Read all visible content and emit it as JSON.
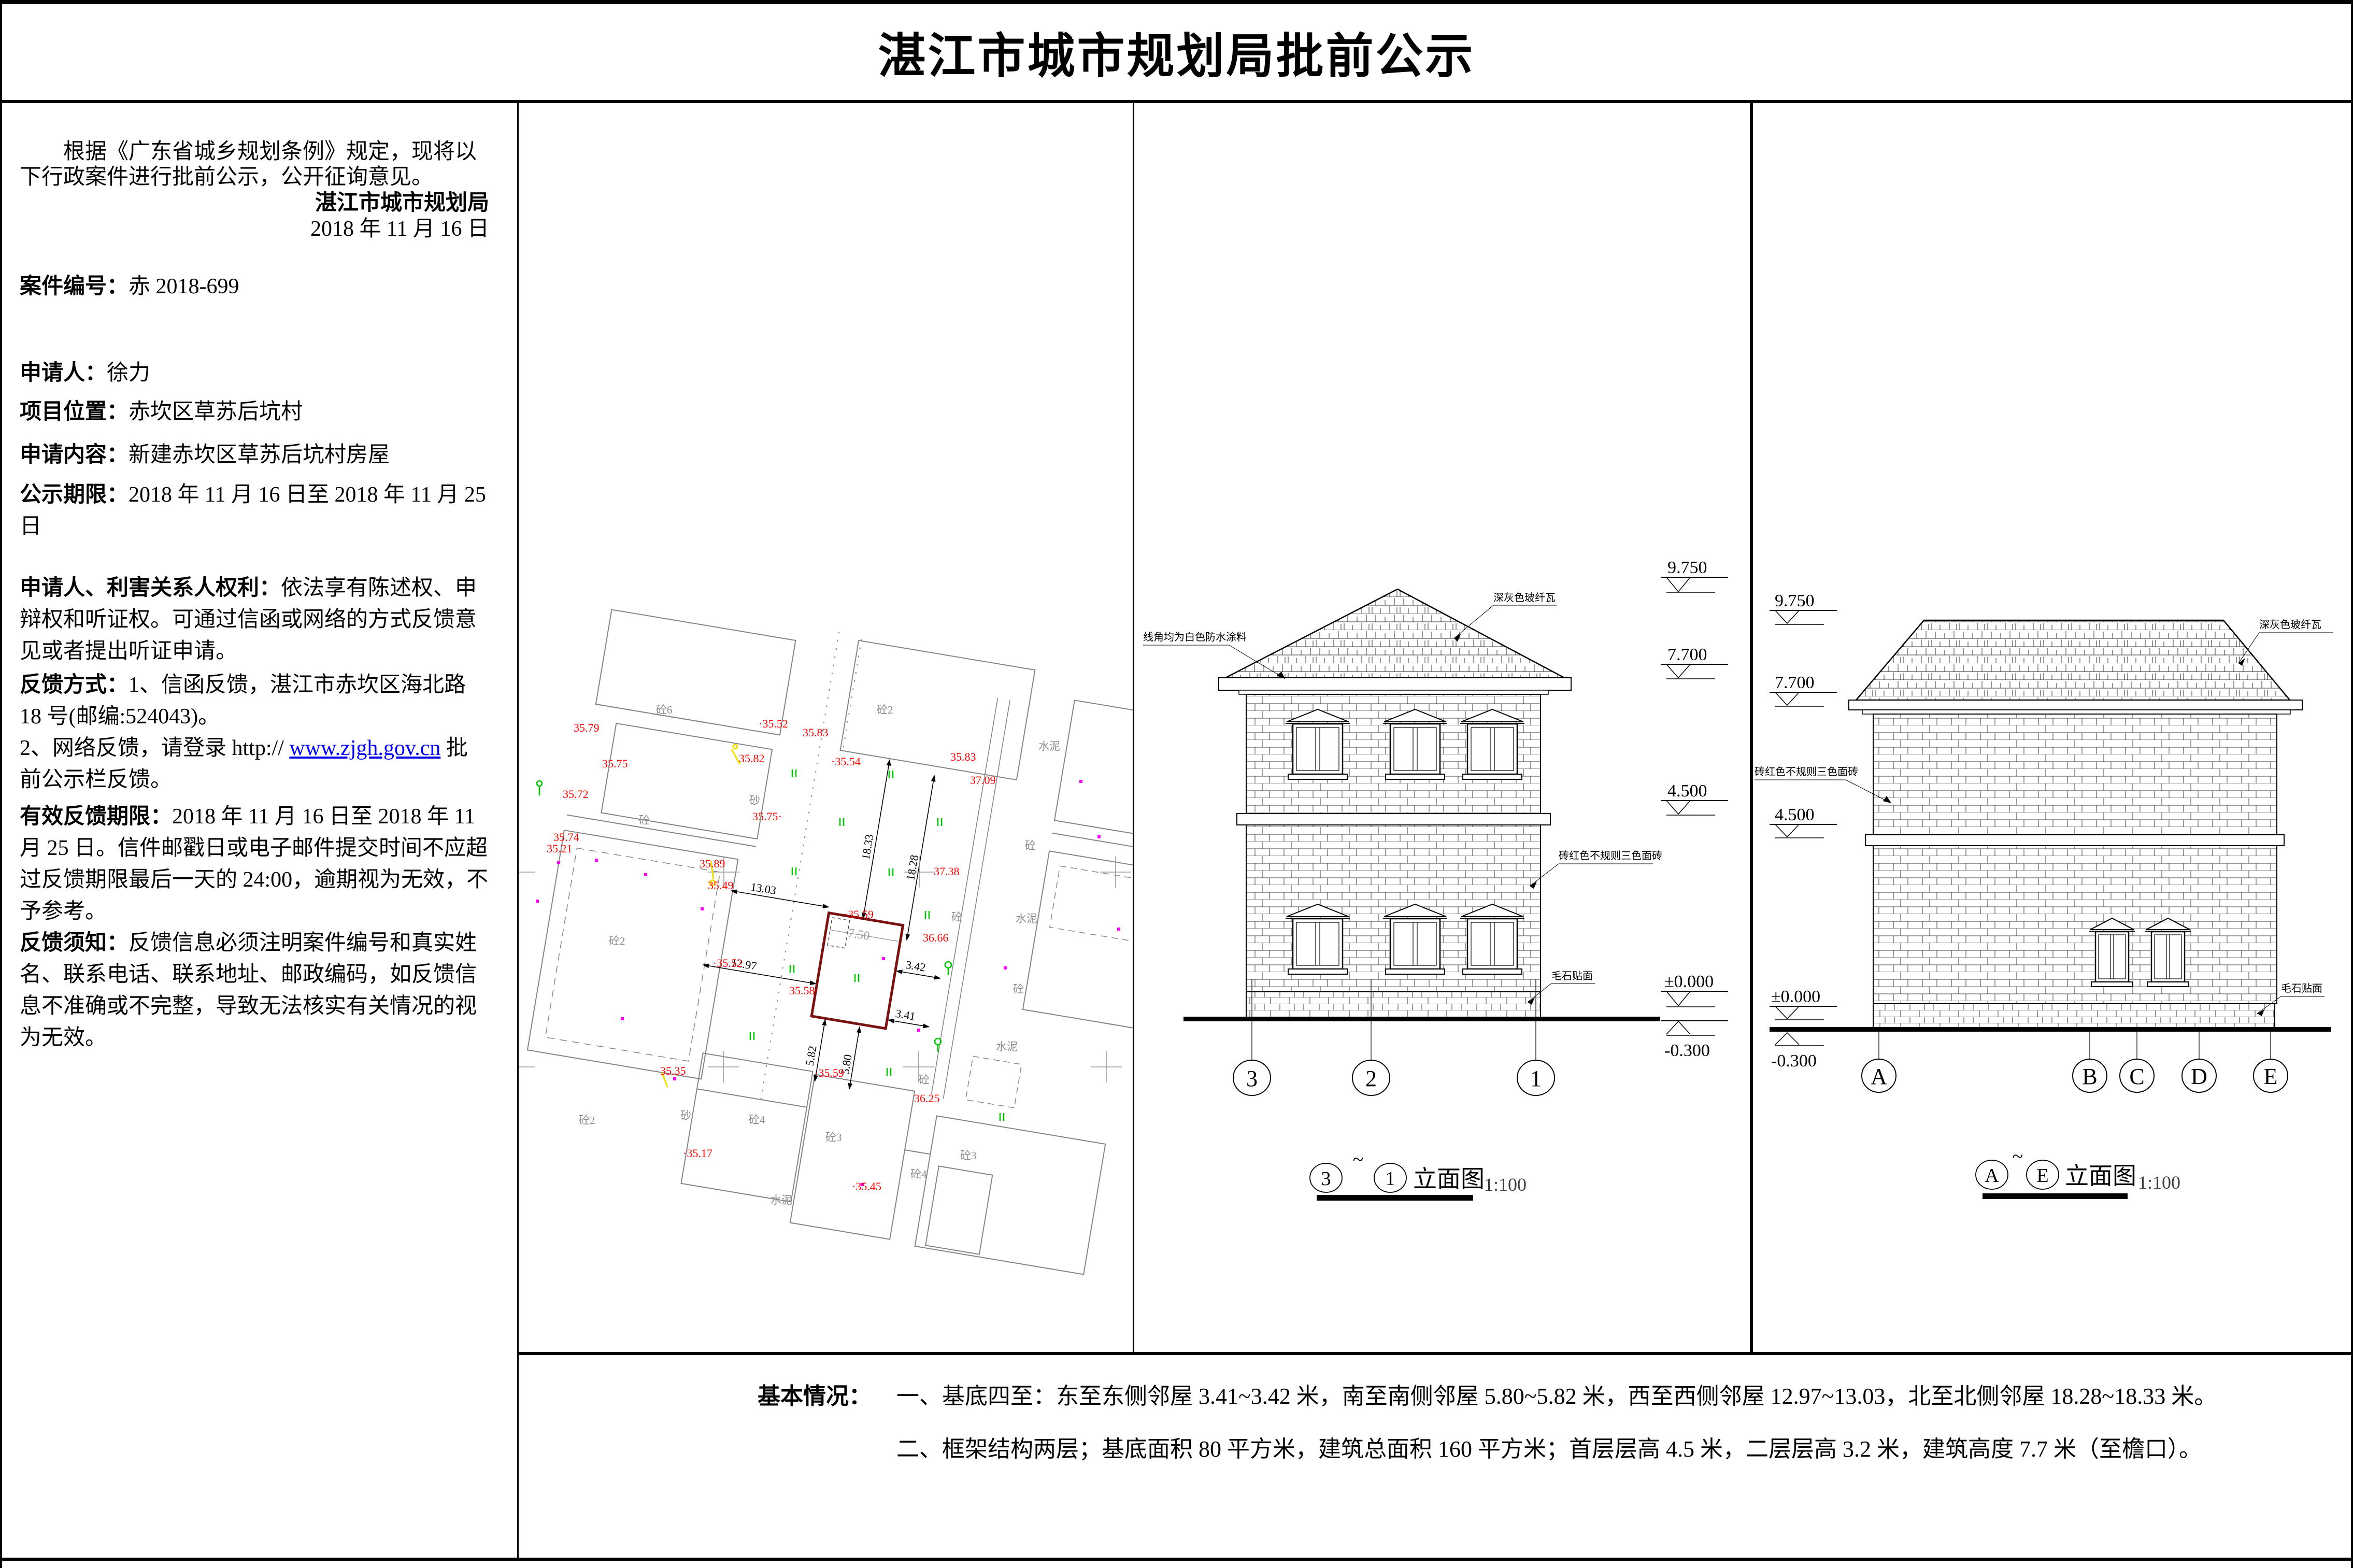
{
  "title": "湛江市城市规划局批前公示",
  "left_panel": {
    "intro": "根据《广东省城乡规划条例》规定，现将以下行政案件进行批前公示，公开征询意见。",
    "agency": "湛江市城市规划局",
    "date": "2018 年 11 月 16 日",
    "fields": [
      {
        "label": "案件编号：",
        "value": "赤 2018-699"
      },
      {
        "label": "申请人：",
        "value": "徐力"
      },
      {
        "label": "项目位置：",
        "value": "赤坎区草苏后坑村"
      },
      {
        "label": "申请内容：",
        "value": "新建赤坎区草苏后坑村房屋"
      },
      {
        "label": "公示期限：",
        "value": "2018 年 11 月 16 日至 2018 年 11 月 25 日"
      },
      {
        "label": "申请人、利害关系人权利：",
        "value": "依法享有陈述权、申辩权和听证权。可通过信函或网络的方式反馈意见或者提出听证申请。"
      },
      {
        "label": "反馈方式：",
        "value": "1、信函反馈，湛江市赤坎区海北路 18 号(邮编:524043)。"
      },
      {
        "label": "",
        "pre": "2、网络反馈，请登录 http:// ",
        "link": "www.zjgh.gov.cn",
        "post": "批前公示栏反馈。"
      },
      {
        "label": "有效反馈期限：",
        "value": "2018 年 11 月 16 日至 2018 年 11 月 25 日。信件邮戳日或电子邮件提交时间不应超过反馈期限最后一天的 24:00，逾期视为无效，不予参考。"
      },
      {
        "label": "反馈须知：",
        "value": "反馈信息必须注明案件编号和真实姓名、联系电话、联系地址、邮政编码，如反馈信息不准确或不完整，导致无法核实有关情况的视为无效。"
      }
    ]
  },
  "site_plan": {
    "spots": [
      "35.79",
      "·35.52",
      "35.83",
      "35.75",
      "35.82",
      "35.83",
      "37.09",
      "35.72",
      "·35.54",
      "35.75·",
      "35.74",
      "35.21",
      "35.89",
      "35.49",
      "37.38",
      "·35.59",
      "36.66",
      "·35.52",
      "35.58·",
      "35.35",
      "·35.59",
      "36.25",
      "·35.17",
      "·35.45"
    ],
    "parcels": [
      "砼6",
      "砼2",
      "水泥",
      "砼",
      "砂",
      "砼2",
      "砼",
      "水泥",
      "砼",
      "砼",
      "水泥",
      "砼2",
      "砂",
      "砼4",
      "砼3",
      "砼3",
      "砼4",
      "水泥",
      "砼"
    ],
    "dims": [
      "18.33",
      "18.28",
      "13.03",
      "12.97",
      "7.50",
      "3.42",
      "3.41",
      "5.82",
      "5.80"
    ]
  },
  "elevation_mid": {
    "levels": [
      "9.750",
      "7.700",
      "4.500",
      "±0.000",
      "-0.300"
    ],
    "roof_note": "深灰色玻纤瓦",
    "eave_note": "线角均为白色防水涂料",
    "wall_note": "砖红色不规则三色面砖",
    "base_note": "毛石贴面",
    "grid": [
      "3",
      "2",
      "1"
    ],
    "caption": {
      "from": "3",
      "tilde": "~",
      "to": "1",
      "text": "立面图",
      "scale": "1:100"
    }
  },
  "elevation_right": {
    "levels": [
      "9.750",
      "7.700",
      "4.500",
      "±0.000",
      "-0.300"
    ],
    "roof_note": "深灰色玻纤瓦",
    "wall_note": "砖红色不规则三色面砖",
    "base_note": "毛石贴面",
    "grid": [
      "A",
      "B",
      "C",
      "D",
      "E"
    ],
    "caption": {
      "from": "A",
      "tilde": "~",
      "to": "E",
      "text": "立面图",
      "scale": "1:100"
    }
  },
  "basic_info": {
    "label": "基本情况：",
    "item1": "一、基底四至：东至东侧邻屋 3.41~3.42 米，南至南侧邻屋 5.80~5.82 米，西至西侧邻屋 12.97~13.03，北至北侧邻屋 18.28~18.33 米。",
    "item2": "二、框架结构两层；基底面积 80 平方米，建筑总面积 160 平方米；首层层高 4.5 米，二层层高 3.2 米，建筑高度 7.7 米（至檐口）。"
  },
  "colors": {
    "accent_red": "#ff0000",
    "proposed_outline": "#7a1010",
    "link_blue": "#0000ee",
    "veg_green": "#00c800",
    "survey_magenta": "#ff00ff",
    "lamp_yellow": "#f0e000"
  }
}
